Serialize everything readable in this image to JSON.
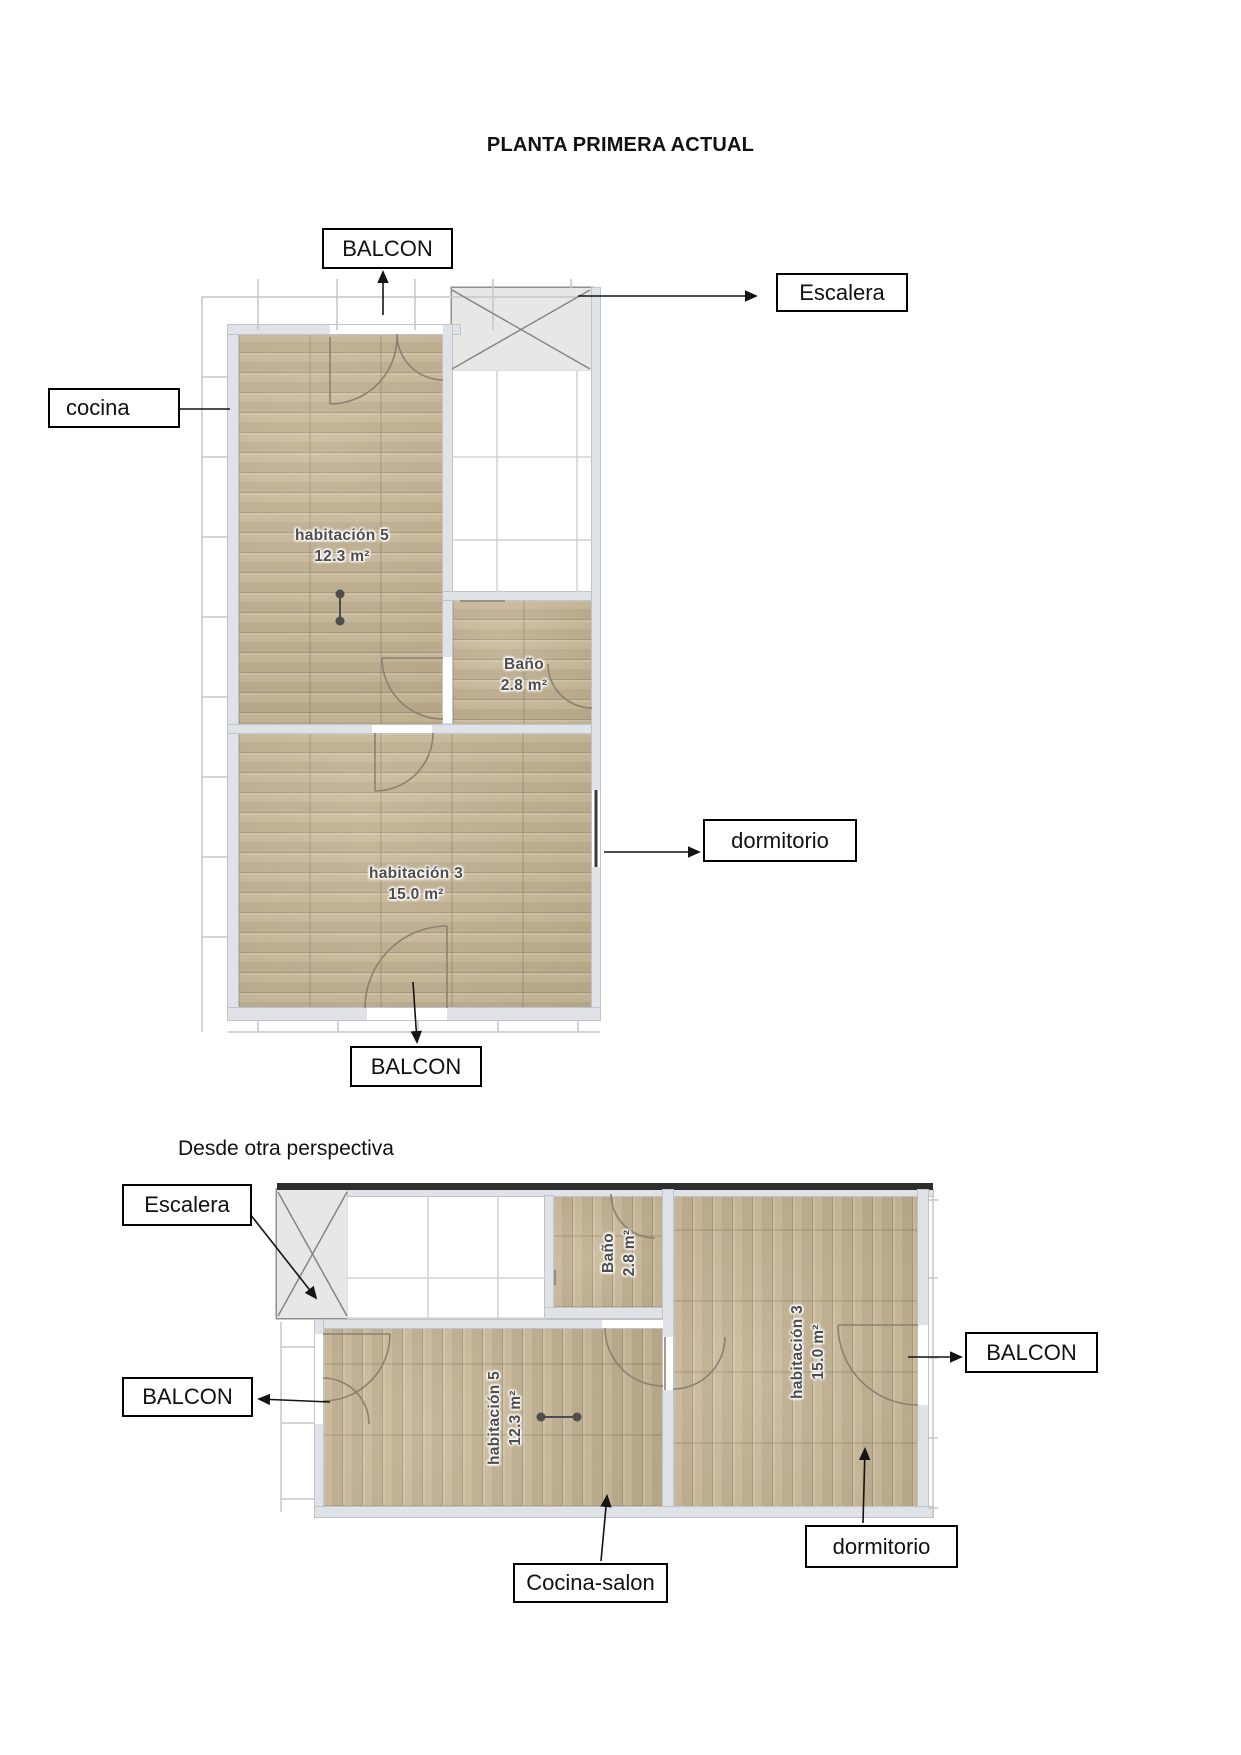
{
  "page": {
    "title": "PLANTA PRIMERA ACTUAL",
    "perspective_note": "Desde otra perspectiva"
  },
  "rooms": {
    "hab5": {
      "name": "habitación 5",
      "area": "12.3 m²"
    },
    "bano": {
      "name": "Baño",
      "area": "2.8 m²"
    },
    "hab3": {
      "name": "habitación 3",
      "area": "15.0 m²"
    }
  },
  "annotations": [
    {
      "id": "balcon-top",
      "label": "BALCON"
    },
    {
      "id": "escalera-plan1",
      "label": "Escalera"
    },
    {
      "id": "cocina",
      "label": "cocina"
    },
    {
      "id": "dormitorio-plan1",
      "label": "dormitorio"
    },
    {
      "id": "balcon-bottom",
      "label": "BALCON"
    },
    {
      "id": "escalera-plan2",
      "label": "Escalera"
    },
    {
      "id": "balcon-left",
      "label": "BALCON"
    },
    {
      "id": "balcon-right",
      "label": "BALCON"
    },
    {
      "id": "dormitorio-plan2",
      "label": "dormitorio"
    },
    {
      "id": "cocina-salon",
      "label": "Cocina-salon"
    }
  ]
}
